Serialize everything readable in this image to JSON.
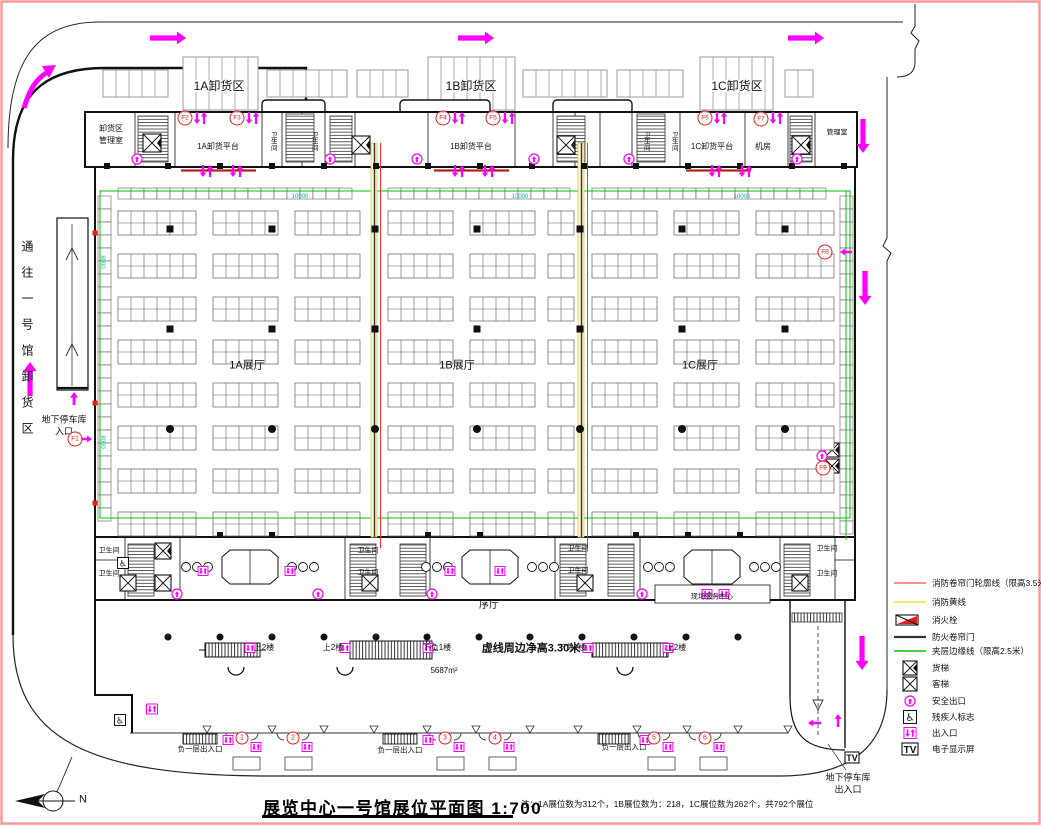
{
  "drawing": {
    "title": "展览中心一号馆展位平面图",
    "scale": "1:700",
    "note": "注：1A展位数为312个，1B展位数为：218，1C展位数为262个，共792个展位",
    "north_label": "N"
  },
  "unloading_zones": [
    "1A卸货区",
    "1B卸货区",
    "1C卸货区"
  ],
  "top_band": {
    "dock_office_line1": "卸货区",
    "dock_office_line2": "管理室",
    "platforms": [
      "1A卸货平台",
      "1B卸货平台",
      "1C卸货平台"
    ],
    "toilet": "卫生间",
    "machine_room": "机房",
    "office": "管理室"
  },
  "halls": [
    "1A展厅",
    "1B展厅",
    "1C展厅"
  ],
  "left_area": {
    "road_label": "通往一号馆卸货区",
    "parking_entry_line1": "地下停车库",
    "parking_entry_line2": "入口"
  },
  "foyer": {
    "lobby": "序厅",
    "service_center": "现场服务中心",
    "toilet": "卫生间",
    "height_note": "虚线周边净高3.30米",
    "area": "5687m²",
    "up_label": "上2楼",
    "down_label": "下负1楼"
  },
  "bottom": {
    "basement_entrance": "负一层出入口",
    "entrance_numbers": [
      "1",
      "2",
      "3",
      "4",
      "5",
      "6"
    ],
    "parking_exit_line1": "地下停车库",
    "parking_exit_line2": "出入口"
  },
  "markers": {
    "f": [
      "F1",
      "F2",
      "F3",
      "F4",
      "F5",
      "F6",
      "F7",
      "F8",
      "F9"
    ]
  },
  "dimensions": {
    "horizontal": "10000",
    "vertical": "8000"
  },
  "screen_text": "TV",
  "legend": {
    "items": [
      {
        "symbol": "line-red",
        "label": "消防卷帘门轮廓线（限高3.5米）"
      },
      {
        "symbol": "line-yellow",
        "label": "消防黄线"
      },
      {
        "symbol": "hydrant",
        "label": "消火栓"
      },
      {
        "symbol": "line-dark",
        "label": "防火卷帘门"
      },
      {
        "symbol": "line-green",
        "label": "夹层边缘线（限高2.5米）"
      },
      {
        "symbol": "freight-elevator",
        "label": "货梯"
      },
      {
        "symbol": "passenger-elevator",
        "label": "客梯"
      },
      {
        "symbol": "safety-exit",
        "label": "安全出口"
      },
      {
        "symbol": "wheelchair",
        "label": "残疾人标志"
      },
      {
        "symbol": "entrance",
        "label": "出入口"
      },
      {
        "symbol": "screen",
        "label": "电子显示屏"
      }
    ]
  },
  "colors": {
    "magenta": "#ff00ff",
    "red": "#ff2a2a",
    "yellow": "#ffe800",
    "green": "#00c300",
    "cyan": "#00cccc",
    "dark": "#3a3a3a",
    "border": "#ff9a9a"
  }
}
